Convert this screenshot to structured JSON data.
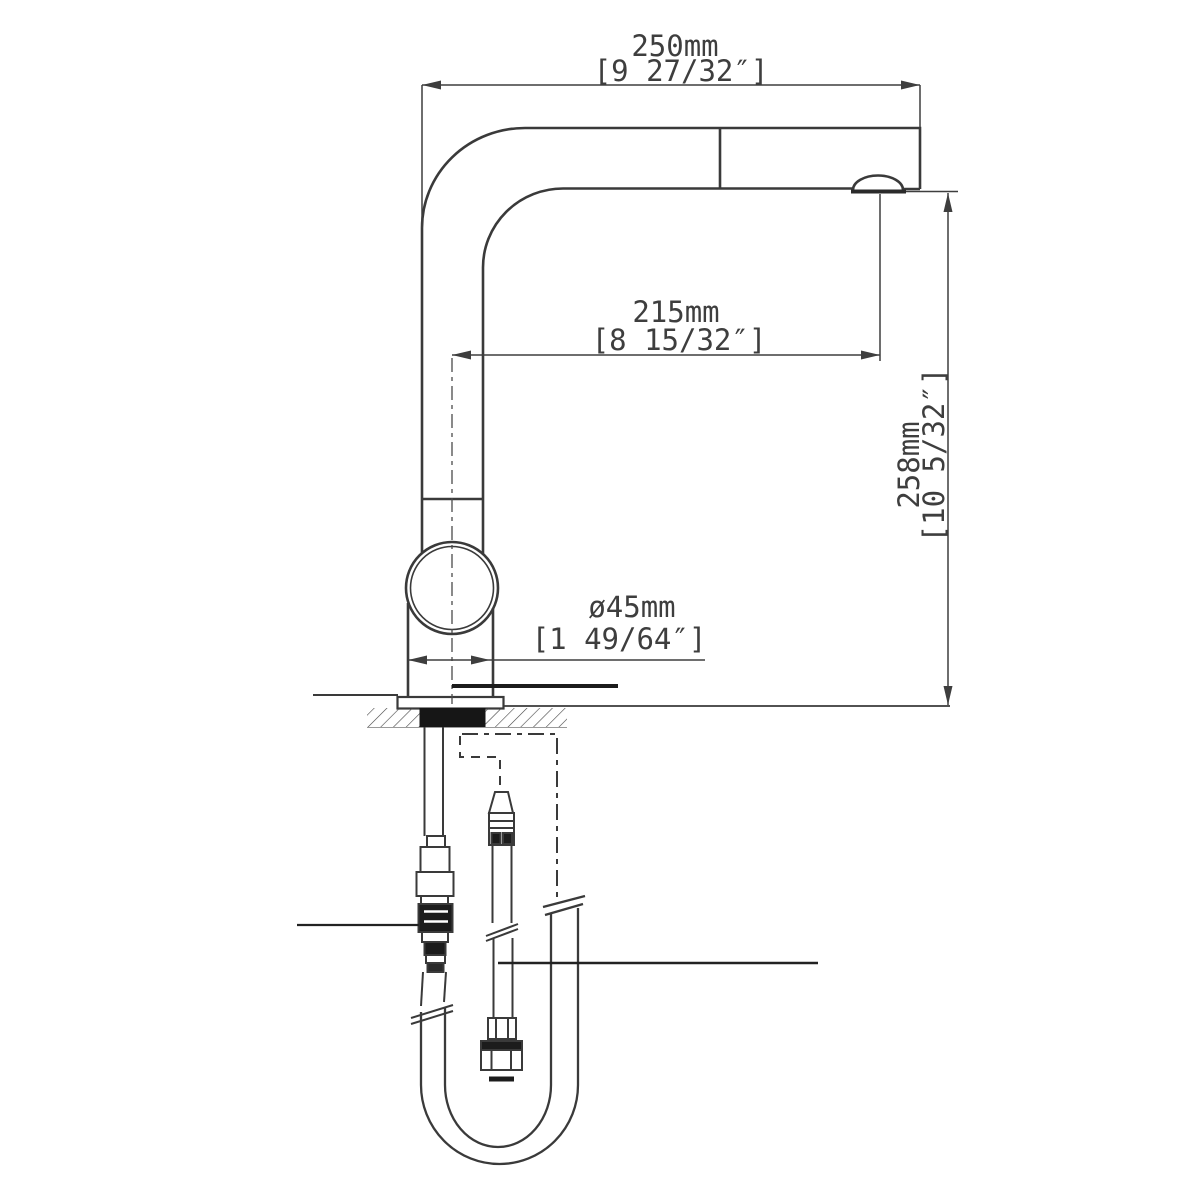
{
  "drawing": {
    "type": "faucet-installation-dimension-diagram",
    "colors": {
      "line": "#3a3a3a",
      "dimension": "#3e3e3e",
      "seal_fill": "#161616",
      "background": "#ffffff"
    },
    "dimensions": {
      "spout_width": {
        "metric": "250mm",
        "imperial": "[9 27/32″]"
      },
      "spout_reach": {
        "metric": "215mm",
        "imperial": "[8 15/32″]"
      },
      "spout_height": {
        "metric": "258mm",
        "imperial": "[10 5/32″]"
      },
      "base_diameter": {
        "metric": "ø45mm",
        "imperial": "[1 49/64″]"
      }
    }
  }
}
